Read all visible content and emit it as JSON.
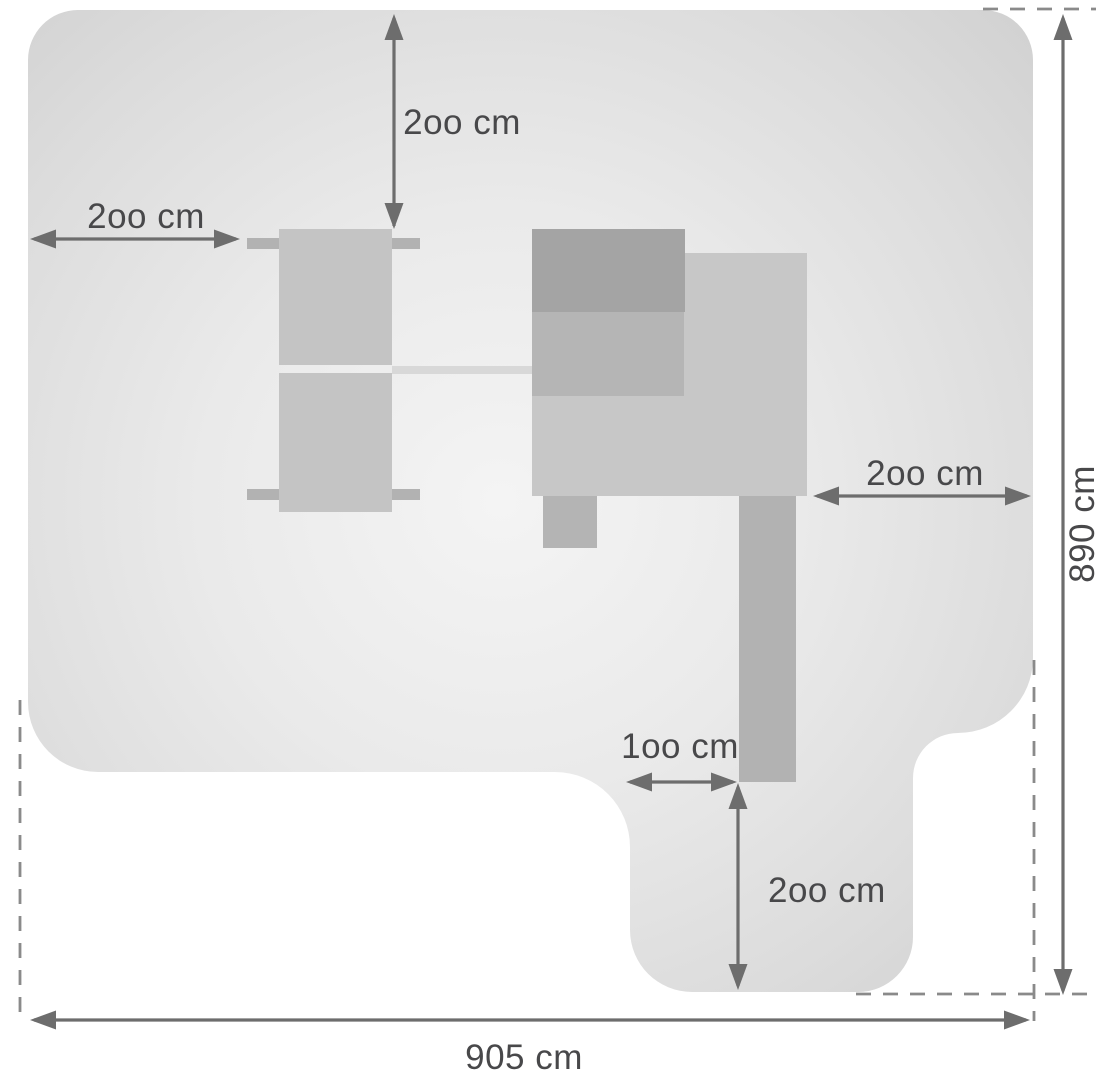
{
  "diagram": {
    "title": "Playset safety zone plan (top view)",
    "unit": "cm",
    "totals": {
      "width": {
        "label": "905 cm",
        "value_cm": 905
      },
      "depth": {
        "label": "890 cm",
        "value_cm": 890
      }
    },
    "clearances": {
      "top": {
        "label": "2oo cm",
        "value_cm": 200
      },
      "left": {
        "label": "2oo cm",
        "value_cm": 200
      },
      "right": {
        "label": "2oo cm",
        "value_cm": 200
      },
      "slide_width": {
        "label": "1oo cm",
        "value_cm": 100
      },
      "slide_runout": {
        "label": "2oo cm",
        "value_cm": 200
      }
    },
    "colors": {
      "zone_center": "#f4f4f4",
      "zone_edge": "#d0d0d0",
      "equipment_dark": "#a4a4a4",
      "equipment_mid": "#b5b5b5",
      "equipment_light": "#c7c7c7",
      "swing_panel": "#c4c4c4",
      "beam": "#d8d8d8",
      "dimension_line": "#6d6d6d",
      "label_text": "#48484a",
      "dashed_line": "#8a8a8a",
      "background": "#ffffff"
    }
  }
}
